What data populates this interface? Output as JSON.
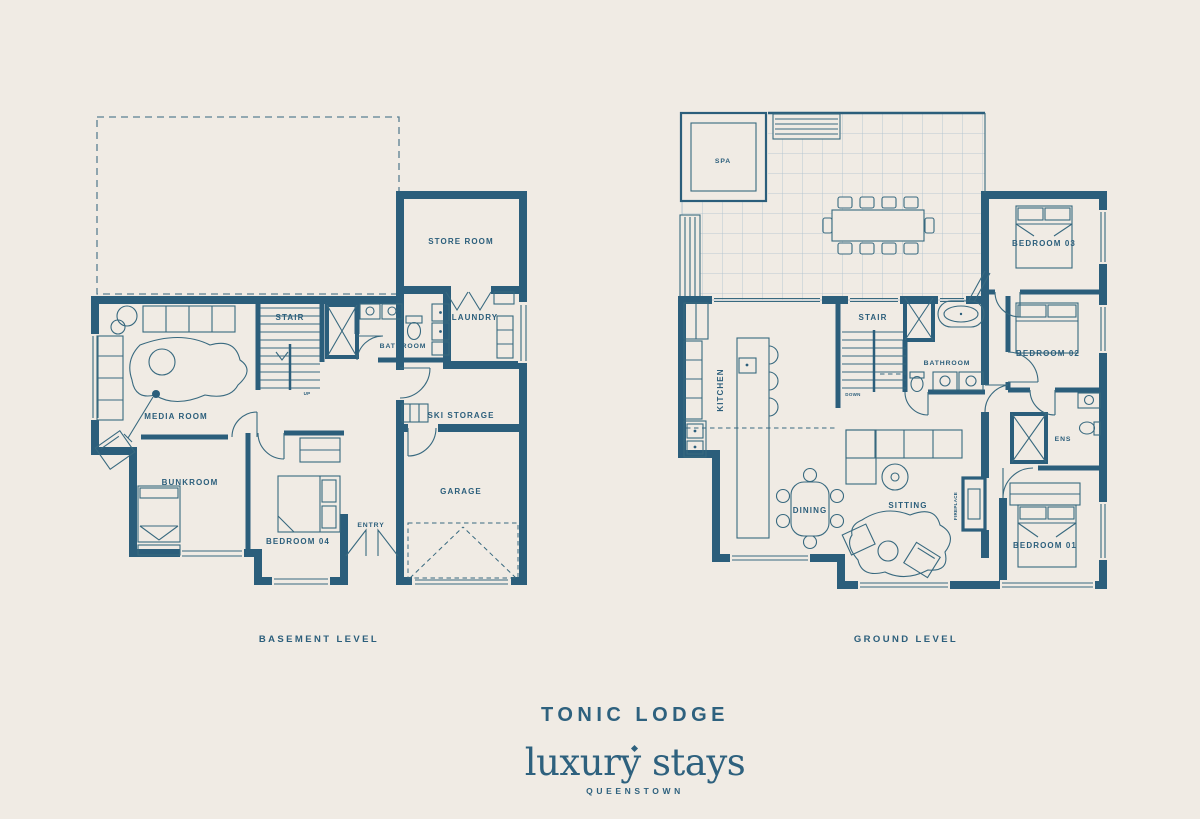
{
  "colors": {
    "background": "#f0ebe4",
    "accent": "#2b5e7b",
    "tile_grid": "#aabfcd"
  },
  "footer": {
    "title": "TONIC LODGE",
    "brand": "luxury stays",
    "location": "QUEENSTOWN"
  },
  "plans": {
    "basement": {
      "level_label": "BASEMENT LEVEL",
      "rooms": {
        "store_room": "STORE ROOM",
        "stair": "STAIR",
        "up": "UP",
        "bathroom": "BATHROOM",
        "laundry": "LAUNDRY",
        "media_room": "MEDIA ROOM",
        "ski_storage": "SKI STORAGE",
        "bunkroom": "BUNKROOM",
        "garage": "GARAGE",
        "bedroom_04": "BEDROOM 04",
        "entry": "ENTRY"
      }
    },
    "ground": {
      "level_label": "GROUND LEVEL",
      "rooms": {
        "spa": "SPA",
        "bedroom_03": "BEDROOM 03",
        "stair": "STAIR",
        "down": "DOWN",
        "kitchen": "KITCHEN",
        "bathroom": "BATHROOM",
        "bedroom_02": "BEDROOM 02",
        "ens": "ENS",
        "dining": "DINING",
        "sitting": "SITTING",
        "fireplace": "FIREPLACE",
        "bedroom_01": "BEDROOM 01"
      }
    }
  }
}
